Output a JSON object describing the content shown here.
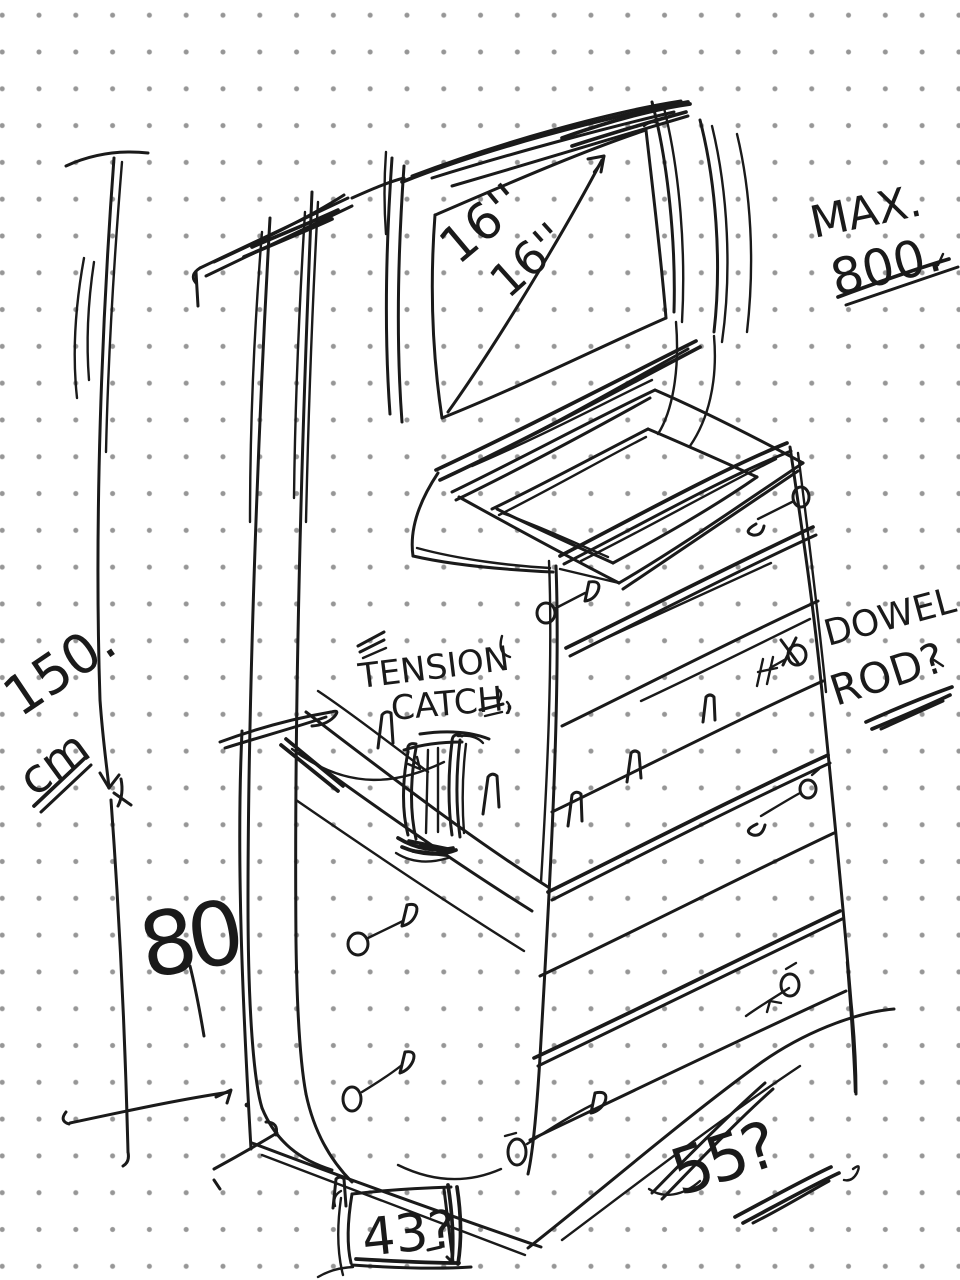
{
  "canvas": {
    "background": "#ffffff",
    "dot_color": "#969696",
    "ink_color": "#1a1a1a"
  },
  "labels": {
    "screen_size_primary": "16''",
    "screen_size_secondary": "16''",
    "max_label": "MAX.",
    "max_value": "800.",
    "height_value": "150.",
    "height_unit": "cm",
    "tension_word1": "TENSION",
    "tension_word2": "CATCH,",
    "dowel_word1": "DOWEL.",
    "dowel_word2": "ROD?",
    "inner_height": "80",
    "depth_query": "55?",
    "base_query": "43?"
  }
}
